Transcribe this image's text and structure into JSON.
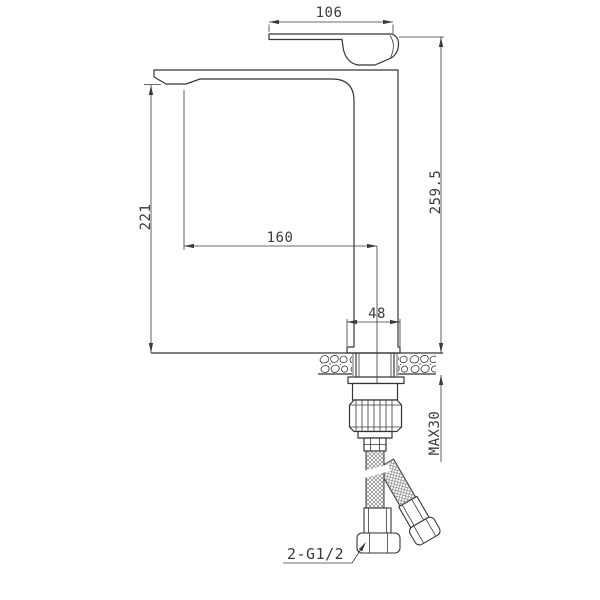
{
  "drawing": {
    "subject": "single-lever tall basin mixer faucet installation diagram",
    "background": "#ffffff",
    "line_color": "#3a3a3a"
  },
  "dims": {
    "handle_length": "106",
    "overall_height": "259.5",
    "outlet_height": "221",
    "spout_reach": "160",
    "base_width": "48",
    "max_thickness": "MAX30",
    "connection": "2-G1/2"
  }
}
